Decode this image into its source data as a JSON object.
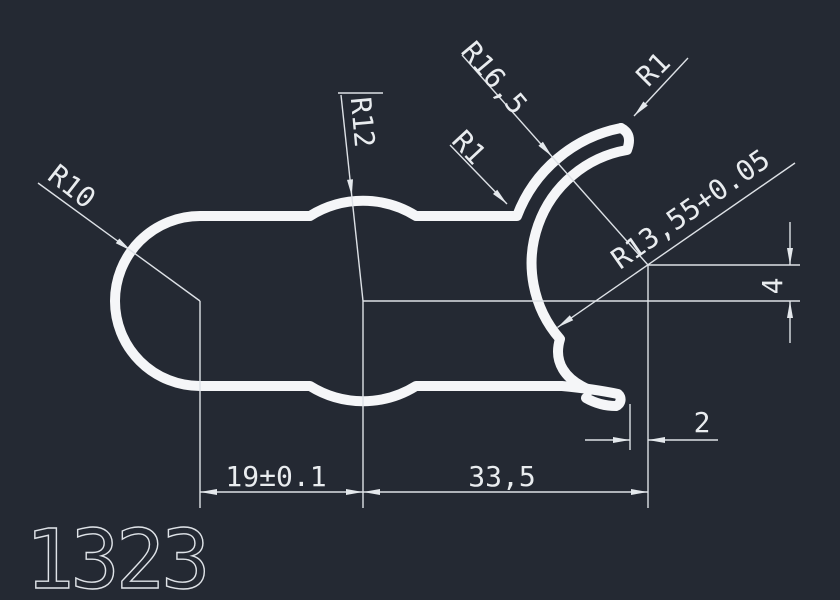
{
  "title_block": {
    "part_number": "1323"
  },
  "annotations": {
    "radii": [
      {
        "name": "r10",
        "label": "R10"
      },
      {
        "name": "r12",
        "label": "R12"
      },
      {
        "name": "r16-5",
        "label": "R16,5"
      },
      {
        "name": "r1-top",
        "label": "R1"
      },
      {
        "name": "r1-left",
        "label": "R1"
      },
      {
        "name": "r13-55",
        "label": "R13,55+0.05"
      }
    ],
    "linear_dimensions": [
      {
        "name": "dim-19",
        "label": "19±0.1"
      },
      {
        "name": "dim-33-5",
        "label": "33,5"
      },
      {
        "name": "dim-4",
        "label": "4"
      },
      {
        "name": "dim-2",
        "label": "2"
      }
    ]
  },
  "colors": {
    "background": "#242933",
    "thin_lines": "#dde1e6",
    "profile_outline": "#f5f6f8",
    "text": "#e9ecef"
  }
}
